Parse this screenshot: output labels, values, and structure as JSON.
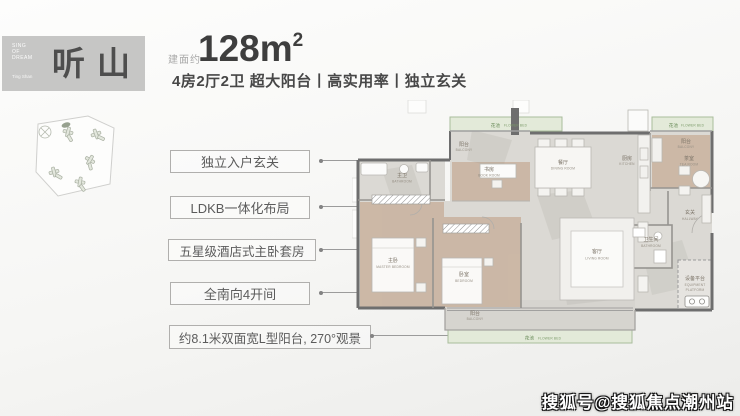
{
  "brand": {
    "name": "听山",
    "tagline_lines": [
      "SING",
      "OF",
      "DREAM"
    ],
    "caption": "Ting Shan"
  },
  "header": {
    "area_label": "建面约",
    "area_value": "128m",
    "area_sup": "2",
    "subtitle": "4房2厅2卫 超大阳台丨高实用率丨独立玄关"
  },
  "features": [
    "独立入户玄关",
    "LDKB一体化布局",
    "五星级酒店式主卧套房",
    "全南向4开间",
    "约8.1米双面宽L型阳台, 270°观景"
  ],
  "floorplan": {
    "flower_bed_cn": "花池",
    "flower_bed_en": "FLOWER BED",
    "balcony_cn": "阳台",
    "balcony_en": "BALCONY",
    "book_room_cn": "书房",
    "book_room_en": "BOOK ROOM",
    "dining_cn": "餐厅",
    "dining_en": "DINING ROOM",
    "kitchen_cn": "厨房",
    "kitchen_en": "KITCHEN",
    "tea_room_cn": "茶室",
    "tea_room_en": "TEA ROOM",
    "master_bath_cn": "主卫",
    "master_bath_en": "BATHROOM",
    "master_bed_cn": "主卧",
    "master_bed_en": "MASTER BEDROOM",
    "bedroom_cn": "卧室",
    "bedroom_en": "BEDROOM",
    "living_cn": "客厅",
    "living_en": "LIVING ROOM",
    "bathroom2_cn": "卫生间",
    "bathroom2_en": "BATHROOM",
    "hallway_cn": "玄关",
    "hallway_en": "HALLWAY",
    "equipment_cn": "设备平台",
    "equipment_en_1": "EQUIPMENT",
    "equipment_en_2": "PLATFORM"
  },
  "watermark": "搜狐号@搜狐焦点潮州站",
  "colors": {
    "flower_bed_green": "#7d9a6c",
    "wood_tan": "#c9b29e",
    "wall_dark": "#6e6e6e",
    "brand_box_gray": "#c6c6c5"
  }
}
